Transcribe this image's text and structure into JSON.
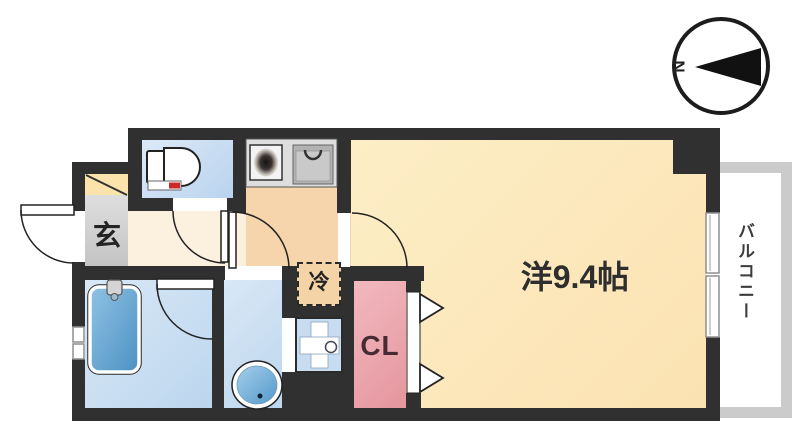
{
  "colors": {
    "wall": "#303030",
    "main-room": "#fdeec6",
    "main-room2": "#fbe2b2",
    "hall": "#fcf0df",
    "kitchen": "#f6d5ac",
    "genkan": "#d2d2d2",
    "shoebox": "#fce3ac",
    "closet-pink": "#f2b9bf",
    "closet-pink2": "#e5959e",
    "water-blue": "#d9e8f6",
    "water-blue2": "#bcd6ee",
    "tub-blue": "#82b9de",
    "tub-blue2": "#4f93c4",
    "fridge-tan": "#f4d4a6",
    "counter-gray": "#dedede",
    "accent-red": "#cc2a2a",
    "balcony-frame": "#cbcbcb"
  },
  "labels": {
    "main_room": "洋9.4帖",
    "closet": "CL",
    "entrance": "玄",
    "refrigerator": "冷",
    "balcony": "バルコニー",
    "compass_north": "N"
  }
}
